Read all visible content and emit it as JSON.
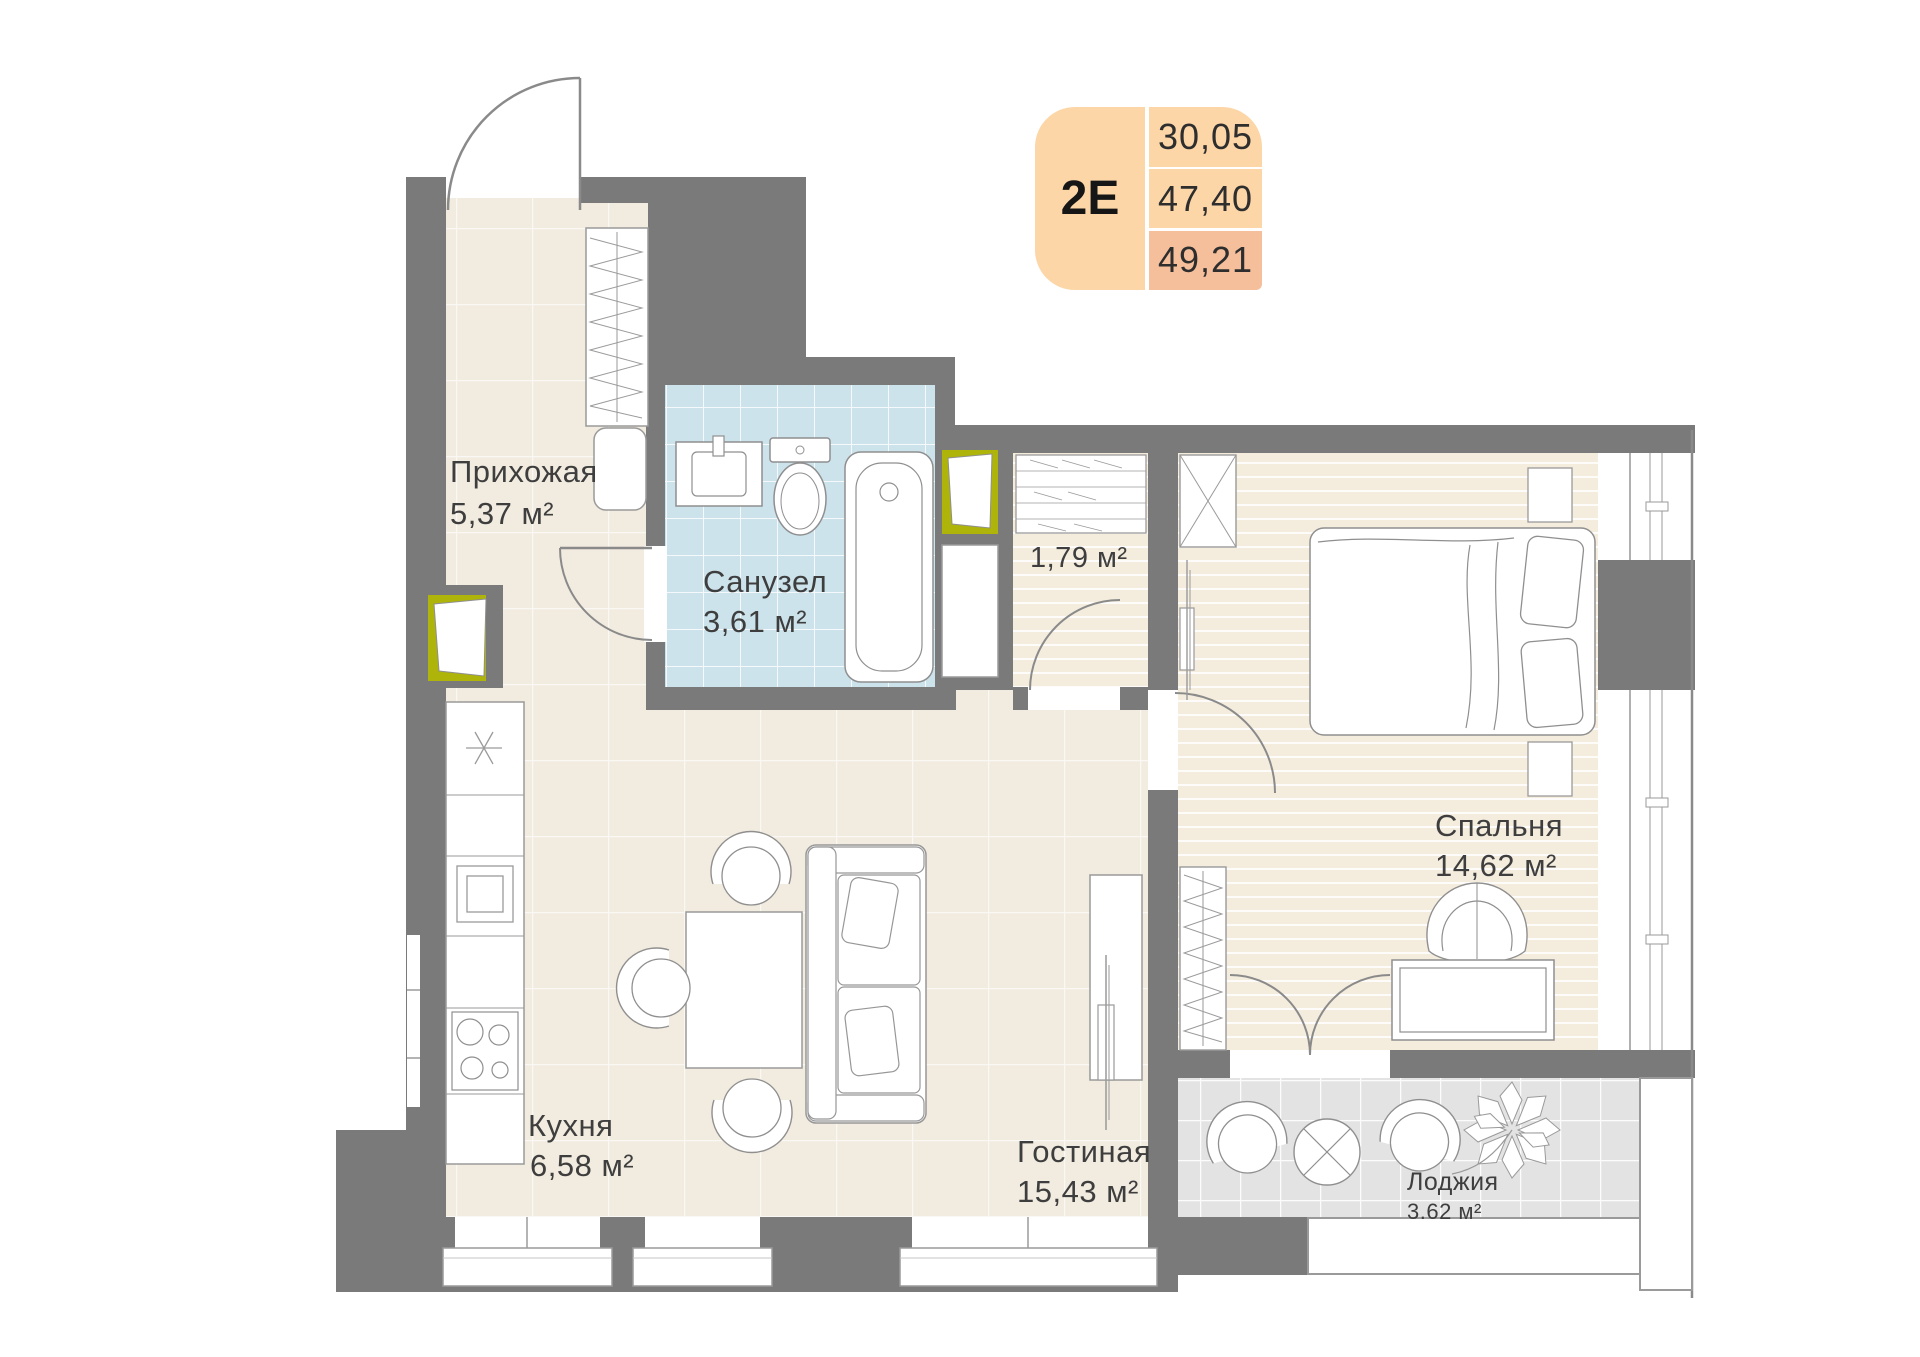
{
  "card": {
    "type": "2E",
    "rows": [
      "30,05",
      "47,40",
      "49,21"
    ]
  },
  "rooms": {
    "hallway": {
      "name": "Прихожая",
      "area": "5,37 м²"
    },
    "bathroom": {
      "name": "Санузел",
      "area": "3,61 м²"
    },
    "storage": {
      "area": "1,79 м²"
    },
    "kitchen": {
      "name": "Кухня",
      "area": "6,58 м²"
    },
    "living": {
      "name": "Гостиная",
      "area": "15,43 м²"
    },
    "bedroom": {
      "name": "Спальня",
      "area": "14,62 м²"
    },
    "loggia": {
      "name": "Лоджия",
      "area": "3.62 м²"
    }
  },
  "colors": {
    "wall": "#7a7a7a",
    "floor_cream": "#f2ebdf",
    "floor_plank": "#f4ecdd",
    "floor_bath": "#cde3ec",
    "floor_loggia": "#e3e3e3",
    "shaft_accent": "#aeb40a",
    "card_peach": "#fcd6a7",
    "card_peach_dark": "#f5bf9b"
  }
}
